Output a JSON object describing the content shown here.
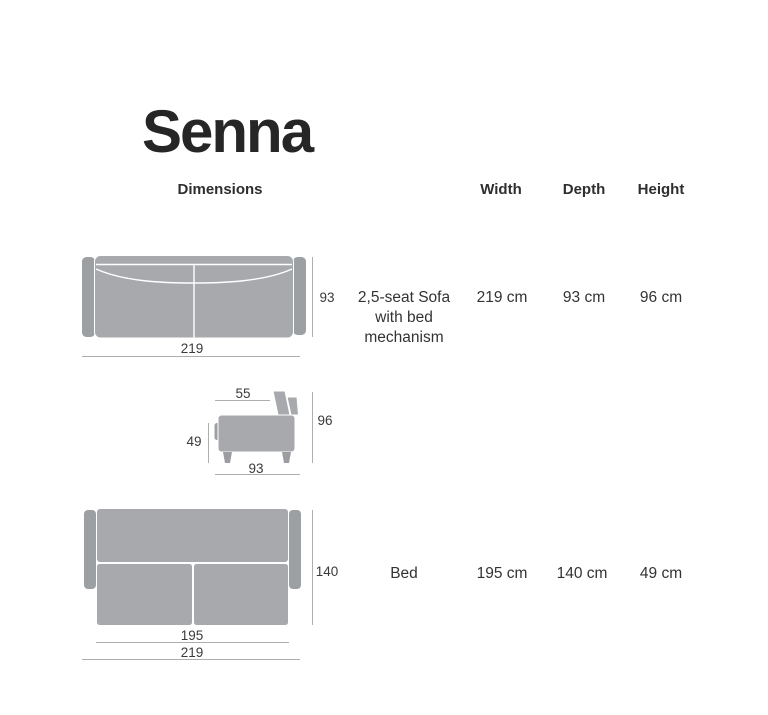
{
  "page": {
    "title": "Senna",
    "subtitle": "Dimensions"
  },
  "table": {
    "columns": {
      "width": "Width",
      "depth": "Depth",
      "height": "Height"
    },
    "rows": [
      {
        "name_line1": "2,5-seat Sofa",
        "name_line2": "with bed",
        "name_line3": "mechanism",
        "width": "219 cm",
        "depth": "93 cm",
        "height": "96 cm"
      },
      {
        "name_line1": "Bed",
        "width": "195 cm",
        "depth": "140 cm",
        "height": "49 cm"
      }
    ]
  },
  "diagrams": {
    "sofa_top_view": {
      "width": "219",
      "depth": "93"
    },
    "sofa_side_view": {
      "seat_depth": "55",
      "height": "96",
      "seat_height": "49",
      "depth": "93"
    },
    "bed_top_view": {
      "depth": "140",
      "bed_width": "195",
      "total_width": "219"
    }
  },
  "colors": {
    "upholstery": "#a7a9ac",
    "upholstery_dark": "#9da0a3",
    "dimension_line": "#aeaeae",
    "text": "#3a3a3a",
    "title_text": "#262626"
  }
}
